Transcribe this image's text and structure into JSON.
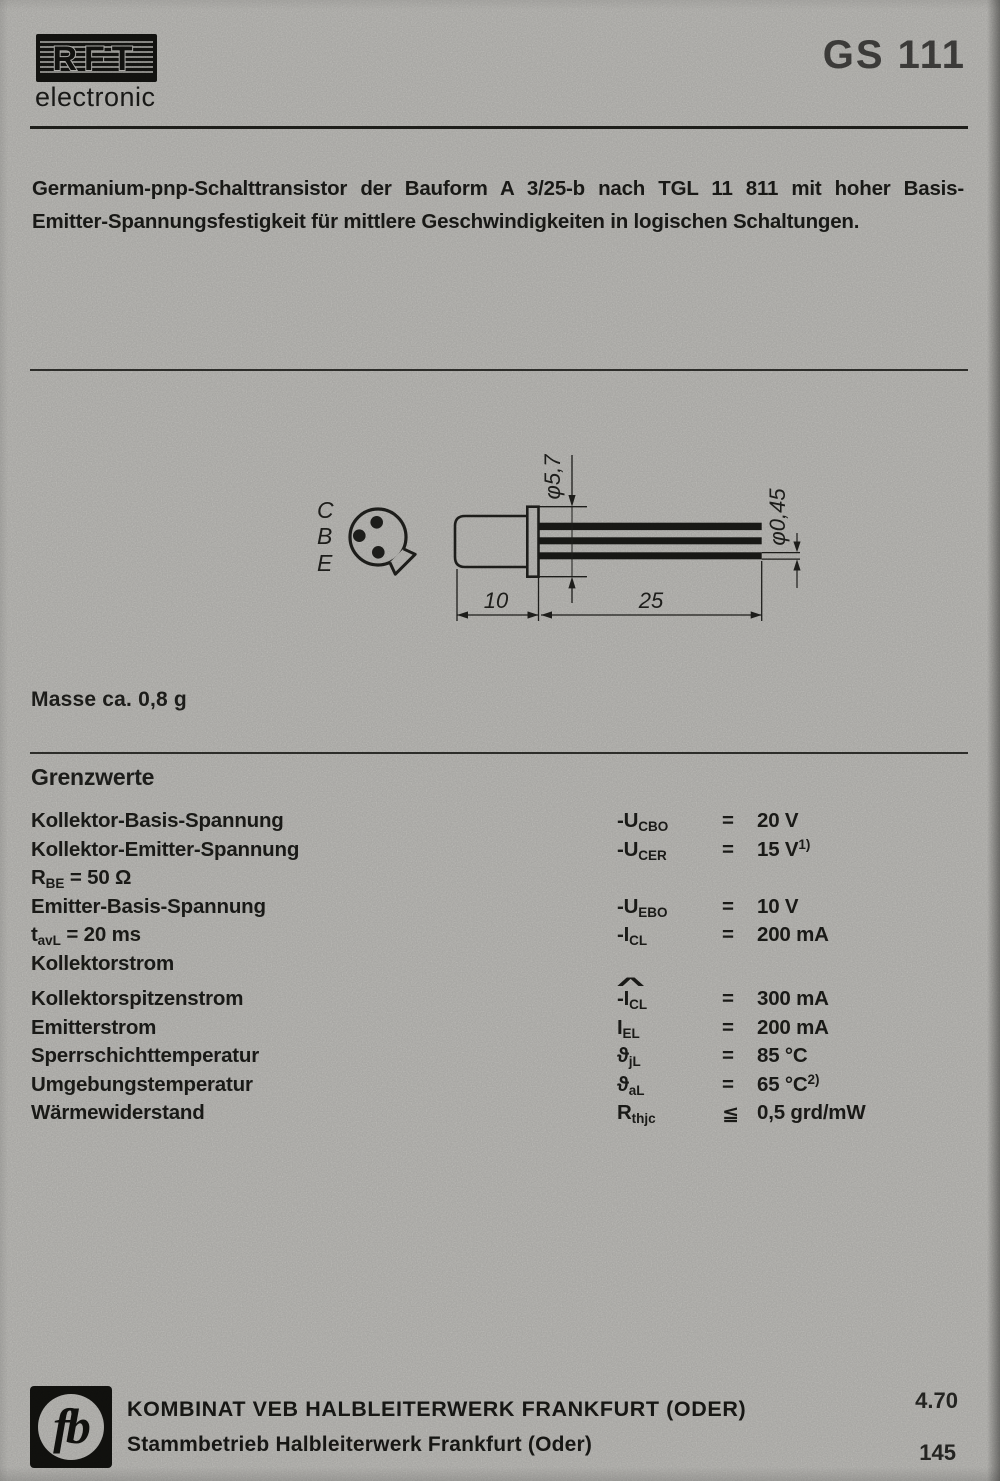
{
  "header": {
    "brand": "RFT",
    "brand_sub": "electronic",
    "part_number": "GS 111"
  },
  "description": {
    "line1": "Germanium-pnp-Schalttransistor der Bauform A 3/25-b nach TGL 11 811 mit hoher Basis-",
    "line2": "Emitter-Spannungsfestigkeit für mittlere Geschwindigkeiten in logischen Schaltungen."
  },
  "drawing": {
    "pin_labels": [
      "C",
      "B",
      "E"
    ],
    "dims": {
      "flange_diameter": "φ5,7",
      "lead_diameter": "φ0,45",
      "body_length": "10",
      "lead_length": "25"
    }
  },
  "mass_note": "Masse ca. 0,8 g",
  "limits": {
    "title": "Grenzwerte",
    "rows": [
      {
        "label": "Kollektor-Basis-Spannung",
        "sym": "-U",
        "sym_sub": "CBO",
        "rel": "=",
        "val": "20 V"
      },
      {
        "label": "Kollektor-Emitter-Spannung",
        "sym": "-U",
        "sym_sub": "CER",
        "rel": "=",
        "val": "15 V",
        "val_sup": "1)"
      },
      {
        "label": "R",
        "label_sub": "BE",
        "label_rest": " = 50 Ω"
      },
      {
        "label": "Emitter-Basis-Spannung",
        "sym": "-U",
        "sym_sub": "EBO",
        "rel": "=",
        "val": "10 V"
      },
      {
        "label": "t",
        "label_sub": "avL",
        "label_rest": " = 20 ms",
        "sym": "-I",
        "sym_sub": "CL",
        "rel": "=",
        "val": "200 mA"
      },
      {
        "label": "Kollektorstrom"
      },
      {
        "label": "Kollektorspitzenstrom",
        "hat": "^",
        "sym": "-I",
        "sym_sub": "CL",
        "rel": "=",
        "val": "300 mA"
      },
      {
        "label": "Emitterstrom",
        "sym": "I",
        "sym_sub": "EL",
        "rel": "=",
        "val": "200 mA"
      },
      {
        "label": "Sperrschichttemperatur",
        "sym": "ϑ",
        "sym_sub": "jL",
        "rel": "=",
        "val": "85 °C"
      },
      {
        "label": "Umgebungstemperatur",
        "sym": "ϑ",
        "sym_sub": "aL",
        "rel": "=",
        "val": "65 °C",
        "val_sup": "2)"
      },
      {
        "label": "Wärmewiderstand",
        "sym": "R",
        "sym_sub": "thjc",
        "rel": "≦",
        "val": "0,5 grd/mW"
      }
    ]
  },
  "footer": {
    "logo_glyph": "fb",
    "company_line1": "KOMBINAT VEB HALBLEITERWERK FRANKFURT (ODER)",
    "company_line2": "Stammbetrieb Halbleiterwerk Frankfurt (Oder)",
    "date_code": "4.70",
    "page_number": "145"
  },
  "colors": {
    "paper": "#c8c7c3",
    "ink": "#22221f"
  }
}
